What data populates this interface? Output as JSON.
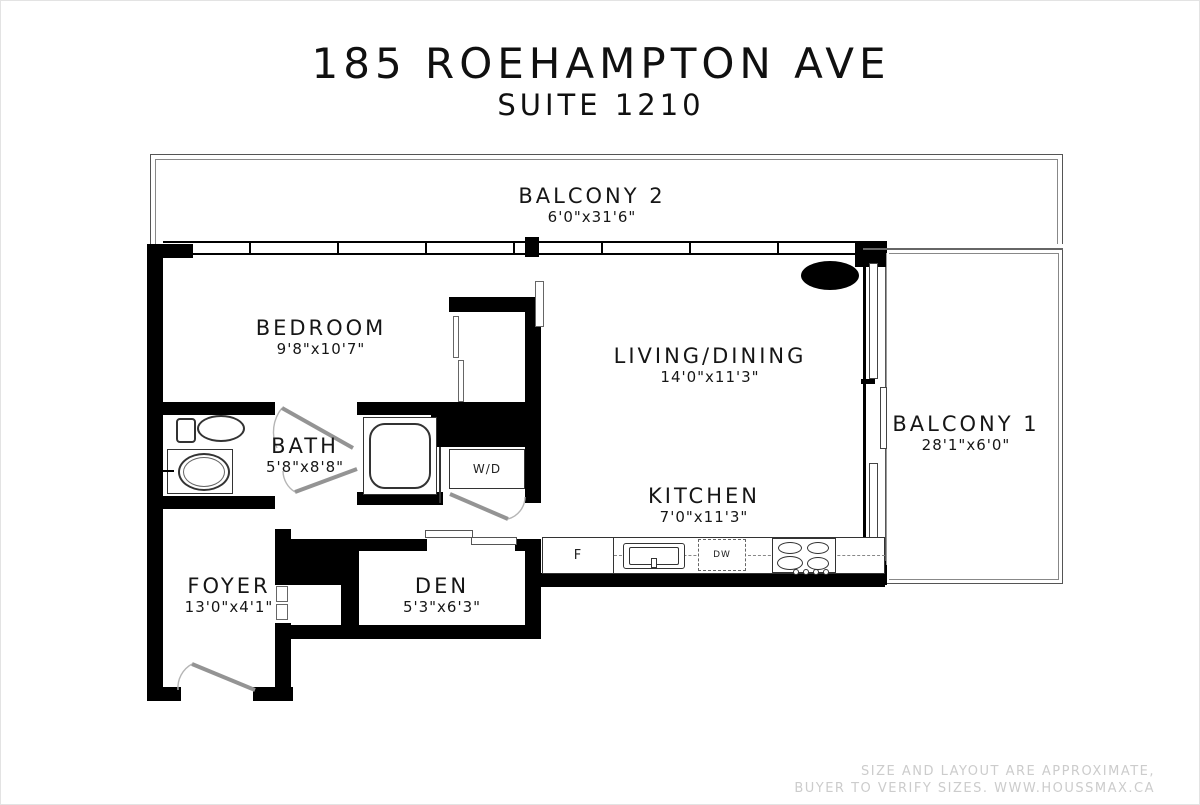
{
  "title": {
    "line1": "185 ROEHAMPTON AVE",
    "line2": "SUITE 1210"
  },
  "rooms": {
    "balcony2": {
      "name": "BALCONY 2",
      "dims": "6'0\"x31'6\""
    },
    "bedroom": {
      "name": "BEDROOM",
      "dims": "9'8\"x10'7\""
    },
    "living": {
      "name": "LIVING/DINING",
      "dims": "14'0\"x11'3\""
    },
    "bath": {
      "name": "BATH",
      "dims": "5'8\"x8'8\""
    },
    "kitchen": {
      "name": "KITCHEN",
      "dims": "7'0\"x11'3\""
    },
    "balcony1": {
      "name": "BALCONY 1",
      "dims": "28'1\"x6'0\""
    },
    "foyer": {
      "name": "FOYER",
      "dims": "13'0\"x4'1\""
    },
    "den": {
      "name": "DEN",
      "dims": "5'3\"x6'3\""
    }
  },
  "fixtures": {
    "washer_dryer": "W/D",
    "fridge": "F",
    "dishwasher": "DW"
  },
  "watermark": {
    "line1": "SIZE AND LAYOUT ARE APPROXIMATE,",
    "line2": "BUYER TO VERIFY SIZES. WWW.HOUSSMAX.CA"
  },
  "colors": {
    "wall": "#000000",
    "thin_line": "#555555",
    "door_line": "#9a9a9a",
    "watermark_text": "#cccccc",
    "background": "#ffffff"
  }
}
